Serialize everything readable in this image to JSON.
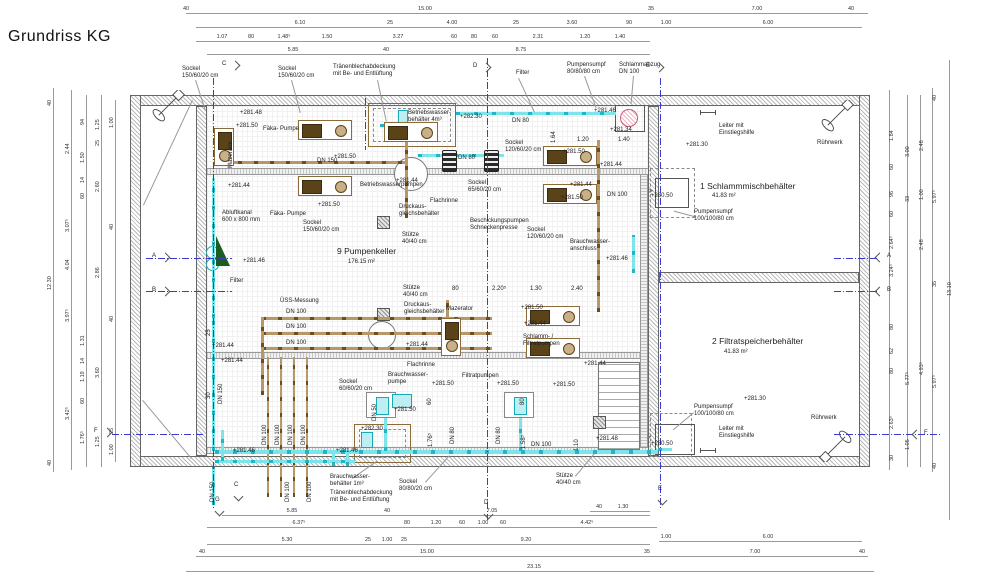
{
  "title": "Grundriss KG",
  "rooms": {
    "pump_cellar": {
      "name": "9 Pumpenkeller",
      "area": "176.15 m²"
    },
    "sludge_tank": {
      "name": "1 Schlammmischbehälter",
      "area": "41.83 m²"
    },
    "filtrate_tank": {
      "name": "2 Filtratspeicherbehälter",
      "area": "41.83 m²"
    }
  },
  "colors": {
    "pipe_cyan": "#1fb6c6",
    "pipe_brown": "#8a6b3a",
    "section_blue": "#3a3acb",
    "sump_pink": "#c2637a",
    "wedge_green": "#1d5c20"
  },
  "annotations": [
    {
      "t": "Sockel\n150/60/20 cm",
      "x": 182,
      "y": 66
    },
    {
      "t": "Sockel\n150/60/20 cm",
      "x": 278,
      "y": 66
    },
    {
      "t": "Tränenblechabdeckung\nmit Be- und Entlüftung",
      "x": 333,
      "y": 64
    },
    {
      "t": "Filter",
      "x": 516,
      "y": 70
    },
    {
      "t": "Pumpensumpf\n80/80/80 cm",
      "x": 567,
      "y": 62
    },
    {
      "t": "Schlammabzug\nDN 100",
      "x": 619,
      "y": 62
    },
    {
      "t": "+281.48",
      "x": 240,
      "y": 110
    },
    {
      "t": "+281.50",
      "x": 236,
      "y": 123
    },
    {
      "t": "Fäka- Pumpe",
      "x": 263,
      "y": 126
    },
    {
      "t": "Mazerator",
      "x": 228,
      "y": 168,
      "rot": 1
    },
    {
      "t": "+281.50",
      "x": 334,
      "y": 154
    },
    {
      "t": "DN 150",
      "x": 317,
      "y": 158
    },
    {
      "t": "+281.44",
      "x": 228,
      "y": 183
    },
    {
      "t": "Fäka- Pumpe",
      "x": 270,
      "y": 211
    },
    {
      "t": "+281.50",
      "x": 318,
      "y": 202
    },
    {
      "t": "Sockel\n150/60/20 cm",
      "x": 303,
      "y": 220
    },
    {
      "t": "Abluftkanal\n600 x 800 mm",
      "x": 222,
      "y": 210
    },
    {
      "t": "+281.46",
      "x": 243,
      "y": 258
    },
    {
      "t": "Filter",
      "x": 230,
      "y": 278
    },
    {
      "t": "Betriebswasser-\nbehälter 4m³",
      "x": 408,
      "y": 110
    },
    {
      "t": "+282.30",
      "x": 460,
      "y": 114
    },
    {
      "t": "DN 80",
      "x": 512,
      "y": 118
    },
    {
      "t": "+281.46",
      "x": 594,
      "y": 108
    },
    {
      "t": "+281.34",
      "x": 610,
      "y": 127
    },
    {
      "t": "1.20",
      "x": 577,
      "y": 137
    },
    {
      "t": "1.40",
      "x": 618,
      "y": 137
    },
    {
      "t": "1.64",
      "x": 551,
      "y": 143,
      "rot": 1
    },
    {
      "t": "Sockel\n120/60/20 cm",
      "x": 505,
      "y": 140
    },
    {
      "t": "+281.50",
      "x": 563,
      "y": 149
    },
    {
      "t": "DN 80",
      "x": 458,
      "y": 155
    },
    {
      "t": "+281.44",
      "x": 600,
      "y": 162
    },
    {
      "t": "+281.44",
      "x": 396,
      "y": 178
    },
    {
      "t": "Betriebswasserpumpen",
      "x": 360,
      "y": 182
    },
    {
      "t": "Sockel\n65/60/20 cm",
      "x": 468,
      "y": 180
    },
    {
      "t": "Flachrinne",
      "x": 430,
      "y": 198
    },
    {
      "t": "Druckaus-\ngleichsbehälter",
      "x": 399,
      "y": 204
    },
    {
      "t": "+281.44",
      "x": 570,
      "y": 182
    },
    {
      "t": "+281.50",
      "x": 561,
      "y": 195
    },
    {
      "t": "DN 100",
      "x": 607,
      "y": 192
    },
    {
      "t": "Beschickungspumpen\nSchneckenpresse",
      "x": 470,
      "y": 218
    },
    {
      "t": "Sockel\n120/60/20 cm",
      "x": 527,
      "y": 227
    },
    {
      "t": "Stütze\n40/40 cm",
      "x": 402,
      "y": 232
    },
    {
      "t": "Brauchwasser-\nanschluss",
      "x": 570,
      "y": 239
    },
    {
      "t": "+281.46",
      "x": 606,
      "y": 256
    },
    {
      "t": "9 Pumpenkeller",
      "x": 337,
      "y": 247,
      "cls": "t"
    },
    {
      "t": "176.15 m²",
      "x": 348,
      "y": 259
    },
    {
      "t": "Leiter mit\nEinstiegshilfe",
      "x": 719,
      "y": 123
    },
    {
      "t": "Rührwerk",
      "x": 817,
      "y": 140
    },
    {
      "t": "+281.30",
      "x": 686,
      "y": 142
    },
    {
      "t": "1 Schlammmischbehälter",
      "x": 700,
      "y": 182,
      "cls": "t"
    },
    {
      "t": "41.83 m²",
      "x": 712,
      "y": 193
    },
    {
      "t": "+280.50",
      "x": 651,
      "y": 193
    },
    {
      "t": "Pumpensumpf\n100/100/80 cm",
      "x": 694,
      "y": 209
    },
    {
      "t": "ÜSS-Messung",
      "x": 280,
      "y": 298
    },
    {
      "t": "DN 100",
      "x": 286,
      "y": 309
    },
    {
      "t": "DN 100",
      "x": 286,
      "y": 324
    },
    {
      "t": "DN 100",
      "x": 286,
      "y": 340
    },
    {
      "t": "25",
      "x": 206,
      "y": 336,
      "rot": 1
    },
    {
      "t": "30",
      "x": 206,
      "y": 399,
      "rot": 1
    },
    {
      "t": "DN 150",
      "x": 218,
      "y": 404,
      "rot": 1
    },
    {
      "t": "+281.44",
      "x": 212,
      "y": 343
    },
    {
      "t": "+281.44",
      "x": 221,
      "y": 358
    },
    {
      "t": "Stütze\n40/40 cm",
      "x": 403,
      "y": 285
    },
    {
      "t": "Druckaus-\ngleichsbehälter",
      "x": 404,
      "y": 302
    },
    {
      "t": "Mazerator",
      "x": 446,
      "y": 306
    },
    {
      "t": "+281.44",
      "x": 406,
      "y": 342
    },
    {
      "t": "Flachrinne",
      "x": 407,
      "y": 362
    },
    {
      "t": "+281.44",
      "x": 584,
      "y": 361
    },
    {
      "t": "80",
      "x": 452,
      "y": 286
    },
    {
      "t": "2.20⁵",
      "x": 492,
      "y": 286
    },
    {
      "t": "1.30",
      "x": 530,
      "y": 286
    },
    {
      "t": "2.40",
      "x": 571,
      "y": 286
    },
    {
      "t": "+281.50",
      "x": 521,
      "y": 305
    },
    {
      "t": "+281.44",
      "x": 524,
      "y": 321
    },
    {
      "t": "Schlamm- /\nFiltratpumpen",
      "x": 523,
      "y": 334
    },
    {
      "t": "+281.50",
      "x": 553,
      "y": 382
    },
    {
      "t": "Brauchwasser-\npumpe",
      "x": 388,
      "y": 372
    },
    {
      "t": "Sockel\n60/60/20 cm",
      "x": 339,
      "y": 379
    },
    {
      "t": "+281.50",
      "x": 432,
      "y": 381
    },
    {
      "t": "+281.50",
      "x": 394,
      "y": 407
    },
    {
      "t": "Filtratpumpen",
      "x": 462,
      "y": 373
    },
    {
      "t": "+281.50",
      "x": 497,
      "y": 381
    },
    {
      "t": "+282.30",
      "x": 361,
      "y": 426
    },
    {
      "t": "DN 50",
      "x": 372,
      "y": 421,
      "rot": 1
    },
    {
      "t": "60",
      "x": 427,
      "y": 405,
      "rot": 1
    },
    {
      "t": "80",
      "x": 520,
      "y": 405,
      "rot": 1
    },
    {
      "t": "DN 80",
      "x": 450,
      "y": 444,
      "rot": 1
    },
    {
      "t": "DN 80",
      "x": 496,
      "y": 444,
      "rot": 1
    },
    {
      "t": "1.76⁵",
      "x": 428,
      "y": 447,
      "rot": 1
    },
    {
      "t": "1.58⁵",
      "x": 521,
      "y": 449,
      "rot": 1
    },
    {
      "t": "1.10",
      "x": 574,
      "y": 451,
      "rot": 1
    },
    {
      "t": "DN 100",
      "x": 531,
      "y": 442
    },
    {
      "t": "+281.48",
      "x": 596,
      "y": 436
    },
    {
      "t": "+281.46",
      "x": 233,
      "y": 448
    },
    {
      "t": "+281.46",
      "x": 336,
      "y": 448
    },
    {
      "t": "2 Filtratspeicherbehälter",
      "x": 712,
      "y": 337,
      "cls": "t"
    },
    {
      "t": "41.83 m²",
      "x": 724,
      "y": 349
    },
    {
      "t": "+281.30",
      "x": 744,
      "y": 396
    },
    {
      "t": "Pumpensumpf\n100/100/80 cm",
      "x": 694,
      "y": 404
    },
    {
      "t": "Leiter mit\nEinstiegshilfe",
      "x": 719,
      "y": 426
    },
    {
      "t": "Rührwerk",
      "x": 811,
      "y": 415
    },
    {
      "t": "+280.50",
      "x": 651,
      "y": 441
    },
    {
      "t": "Stütze\n40/40 cm",
      "x": 556,
      "y": 473
    },
    {
      "t": "Sockel\n80/80/20 cm",
      "x": 399,
      "y": 479
    },
    {
      "t": "Brauchwasser-\nbehälter 1m³",
      "x": 330,
      "y": 474
    },
    {
      "t": "Tränenblechabdeckung\nmit Be- und Entlüftung",
      "x": 330,
      "y": 490
    },
    {
      "t": "DN 150",
      "x": 210,
      "y": 502,
      "rot": 1
    },
    {
      "t": "DN 100",
      "x": 285,
      "y": 502,
      "rot": 1
    },
    {
      "t": "DN 100",
      "x": 307,
      "y": 502,
      "rot": 1
    },
    {
      "t": "DN 100",
      "x": 262,
      "y": 445,
      "rot": 1
    },
    {
      "t": "DN 100",
      "x": 275,
      "y": 445,
      "rot": 1
    },
    {
      "t": "DN 100",
      "x": 288,
      "y": 445,
      "rot": 1
    },
    {
      "t": "DN 100",
      "x": 301,
      "y": 445,
      "rot": 1
    }
  ],
  "dims": [
    {
      "t": "40",
      "x": 186,
      "y": 6
    },
    {
      "t": "15.00",
      "x": 425,
      "y": 6
    },
    {
      "t": "35",
      "x": 651,
      "y": 6
    },
    {
      "t": "7.00",
      "x": 757,
      "y": 6
    },
    {
      "t": "40",
      "x": 851,
      "y": 6
    },
    {
      "t": "6.10",
      "x": 300,
      "y": 20
    },
    {
      "t": "25",
      "x": 390,
      "y": 20
    },
    {
      "t": "4.00",
      "x": 452,
      "y": 20
    },
    {
      "t": "25",
      "x": 516,
      "y": 20
    },
    {
      "t": "3.60",
      "x": 572,
      "y": 20
    },
    {
      "t": "90",
      "x": 629,
      "y": 20
    },
    {
      "t": "1.00",
      "x": 666,
      "y": 20
    },
    {
      "t": "6.00",
      "x": 768,
      "y": 20
    },
    {
      "t": "1.07",
      "x": 222,
      "y": 34
    },
    {
      "t": "80",
      "x": 251,
      "y": 34
    },
    {
      "t": "1.48⁵",
      "x": 284,
      "y": 34
    },
    {
      "t": "1.50",
      "x": 327,
      "y": 34
    },
    {
      "t": "3.27",
      "x": 398,
      "y": 34
    },
    {
      "t": "60",
      "x": 454,
      "y": 34
    },
    {
      "t": "80",
      "x": 474,
      "y": 34
    },
    {
      "t": "60",
      "x": 495,
      "y": 34
    },
    {
      "t": "2.31",
      "x": 538,
      "y": 34
    },
    {
      "t": "1.20",
      "x": 585,
      "y": 34
    },
    {
      "t": "1.40",
      "x": 620,
      "y": 34
    },
    {
      "t": "5.85",
      "x": 293,
      "y": 47
    },
    {
      "t": "40",
      "x": 386,
      "y": 47
    },
    {
      "t": "8.75",
      "x": 521,
      "y": 47
    },
    {
      "t": "40",
      "x": 599,
      "y": 504
    },
    {
      "t": "1.30",
      "x": 623,
      "y": 504
    },
    {
      "t": "5.85",
      "x": 292,
      "y": 508
    },
    {
      "t": "40",
      "x": 387,
      "y": 508
    },
    {
      "t": "7.05",
      "x": 492,
      "y": 508
    },
    {
      "t": "6.37⁵",
      "x": 299,
      "y": 520
    },
    {
      "t": "80",
      "x": 407,
      "y": 520
    },
    {
      "t": "1.20",
      "x": 436,
      "y": 520
    },
    {
      "t": "60",
      "x": 462,
      "y": 520
    },
    {
      "t": "1.00",
      "x": 483,
      "y": 520
    },
    {
      "t": "60",
      "x": 503,
      "y": 520
    },
    {
      "t": "4.42⁵",
      "x": 587,
      "y": 520
    },
    {
      "t": "1.00",
      "x": 666,
      "y": 534
    },
    {
      "t": "6.00",
      "x": 768,
      "y": 534
    },
    {
      "t": "5.30",
      "x": 287,
      "y": 537
    },
    {
      "t": "25",
      "x": 368,
      "y": 537
    },
    {
      "t": "1.00",
      "x": 387,
      "y": 537
    },
    {
      "t": "25",
      "x": 404,
      "y": 537
    },
    {
      "t": "9.20",
      "x": 526,
      "y": 537
    },
    {
      "t": "40",
      "x": 202,
      "y": 549
    },
    {
      "t": "15.00",
      "x": 427,
      "y": 549
    },
    {
      "t": "35",
      "x": 647,
      "y": 549
    },
    {
      "t": "7.00",
      "x": 755,
      "y": 549
    },
    {
      "t": "40",
      "x": 862,
      "y": 549
    },
    {
      "t": "23.15",
      "x": 534,
      "y": 564
    },
    {
      "t": "40",
      "x": 47,
      "y": 106,
      "rot": 1
    },
    {
      "t": "12.30",
      "x": 47,
      "y": 290,
      "rot": 1
    },
    {
      "t": "40",
      "x": 47,
      "y": 466,
      "rot": 1
    },
    {
      "t": "2.44",
      "x": 65,
      "y": 154,
      "rot": 1
    },
    {
      "t": "3.07⁵",
      "x": 65,
      "y": 232,
      "rot": 1
    },
    {
      "t": "4.04",
      "x": 65,
      "y": 270,
      "rot": 1
    },
    {
      "t": "3.97⁵",
      "x": 65,
      "y": 322,
      "rot": 1
    },
    {
      "t": "3.42⁵",
      "x": 65,
      "y": 420,
      "rot": 1
    },
    {
      "t": "94",
      "x": 80,
      "y": 125,
      "rot": 1
    },
    {
      "t": "1.50",
      "x": 80,
      "y": 163,
      "rot": 1
    },
    {
      "t": "14",
      "x": 80,
      "y": 183,
      "rot": 1
    },
    {
      "t": "60",
      "x": 80,
      "y": 199,
      "rot": 1
    },
    {
      "t": "1.31",
      "x": 80,
      "y": 346,
      "rot": 1
    },
    {
      "t": "14",
      "x": 80,
      "y": 364,
      "rot": 1
    },
    {
      "t": "1.19",
      "x": 80,
      "y": 382,
      "rot": 1
    },
    {
      "t": "60",
      "x": 80,
      "y": 404,
      "rot": 1
    },
    {
      "t": "1.76⁵",
      "x": 80,
      "y": 444,
      "rot": 1
    },
    {
      "t": "1.25",
      "x": 95,
      "y": 130,
      "rot": 1
    },
    {
      "t": "25",
      "x": 95,
      "y": 146,
      "rot": 1
    },
    {
      "t": "2.60",
      "x": 95,
      "y": 192,
      "rot": 1
    },
    {
      "t": "2.86",
      "x": 95,
      "y": 278,
      "rot": 1
    },
    {
      "t": "3.60",
      "x": 95,
      "y": 378,
      "rot": 1
    },
    {
      "t": "1.25",
      "x": 95,
      "y": 447,
      "rot": 1
    },
    {
      "t": "1.00",
      "x": 109,
      "y": 128,
      "rot": 1
    },
    {
      "t": "40",
      "x": 109,
      "y": 230,
      "rot": 1
    },
    {
      "t": "40",
      "x": 109,
      "y": 322,
      "rot": 1
    },
    {
      "t": "25",
      "x": 109,
      "y": 434,
      "rot": 1
    },
    {
      "t": "1.00",
      "x": 109,
      "y": 455,
      "rot": 1
    },
    {
      "t": "1.84",
      "x": 889,
      "y": 141,
      "rot": 1
    },
    {
      "t": "60",
      "x": 889,
      "y": 170,
      "rot": 1
    },
    {
      "t": "96",
      "x": 889,
      "y": 197,
      "rot": 1
    },
    {
      "t": "60",
      "x": 889,
      "y": 217,
      "rot": 1
    },
    {
      "t": "2.64⁵",
      "x": 889,
      "y": 249,
      "rot": 1
    },
    {
      "t": "3.24⁵",
      "x": 889,
      "y": 277,
      "rot": 1
    },
    {
      "t": "80",
      "x": 889,
      "y": 330,
      "rot": 1
    },
    {
      "t": "62",
      "x": 889,
      "y": 354,
      "rot": 1
    },
    {
      "t": "80",
      "x": 889,
      "y": 374,
      "rot": 1
    },
    {
      "t": "2.63⁵",
      "x": 889,
      "y": 429,
      "rot": 1
    },
    {
      "t": "30",
      "x": 889,
      "y": 461,
      "rot": 1
    },
    {
      "t": "3.00",
      "x": 905,
      "y": 157,
      "rot": 1
    },
    {
      "t": "33",
      "x": 905,
      "y": 202,
      "rot": 1
    },
    {
      "t": "5.77⁵",
      "x": 905,
      "y": 385,
      "rot": 1
    },
    {
      "t": "1.05",
      "x": 905,
      "y": 450,
      "rot": 1
    },
    {
      "t": "2.48",
      "x": 919,
      "y": 151,
      "rot": 1
    },
    {
      "t": "1.00",
      "x": 919,
      "y": 200,
      "rot": 1
    },
    {
      "t": "2.48",
      "x": 919,
      "y": 250,
      "rot": 1
    },
    {
      "t": "4.93⁵",
      "x": 919,
      "y": 375,
      "rot": 1
    },
    {
      "t": "40",
      "x": 932,
      "y": 101,
      "rot": 1
    },
    {
      "t": "5.97⁵",
      "x": 932,
      "y": 203,
      "rot": 1
    },
    {
      "t": "35",
      "x": 932,
      "y": 287,
      "rot": 1
    },
    {
      "t": "5.97⁵",
      "x": 932,
      "y": 388,
      "rot": 1
    },
    {
      "t": "40",
      "x": 932,
      "y": 469,
      "rot": 1
    },
    {
      "t": "13.10",
      "x": 947,
      "y": 296,
      "rot": 1
    }
  ],
  "markers": [
    {
      "l": "C",
      "x": 230,
      "y": 60,
      "d": "r"
    },
    {
      "l": "D",
      "x": 481,
      "y": 62,
      "d": "r"
    },
    {
      "l": "E",
      "x": 654,
      "y": 62,
      "d": "r"
    },
    {
      "l": "A",
      "x": 160,
      "y": 252,
      "d": "r"
    },
    {
      "l": "B",
      "x": 160,
      "y": 286,
      "d": "r"
    },
    {
      "l": "F",
      "x": 102,
      "y": 427,
      "d": "r"
    },
    {
      "l": "A",
      "x": 874,
      "y": 252,
      "d": "l"
    },
    {
      "l": "B",
      "x": 874,
      "y": 286,
      "d": "l"
    },
    {
      "l": "F",
      "x": 911,
      "y": 429,
      "d": "l"
    },
    {
      "l": "G",
      "x": 214,
      "y": 506,
      "d": "d"
    },
    {
      "l": "C",
      "x": 233,
      "y": 491,
      "d": "d"
    },
    {
      "l": "D",
      "x": 483,
      "y": 509,
      "d": "d"
    },
    {
      "l": "E",
      "x": 657,
      "y": 495,
      "d": "d"
    }
  ]
}
